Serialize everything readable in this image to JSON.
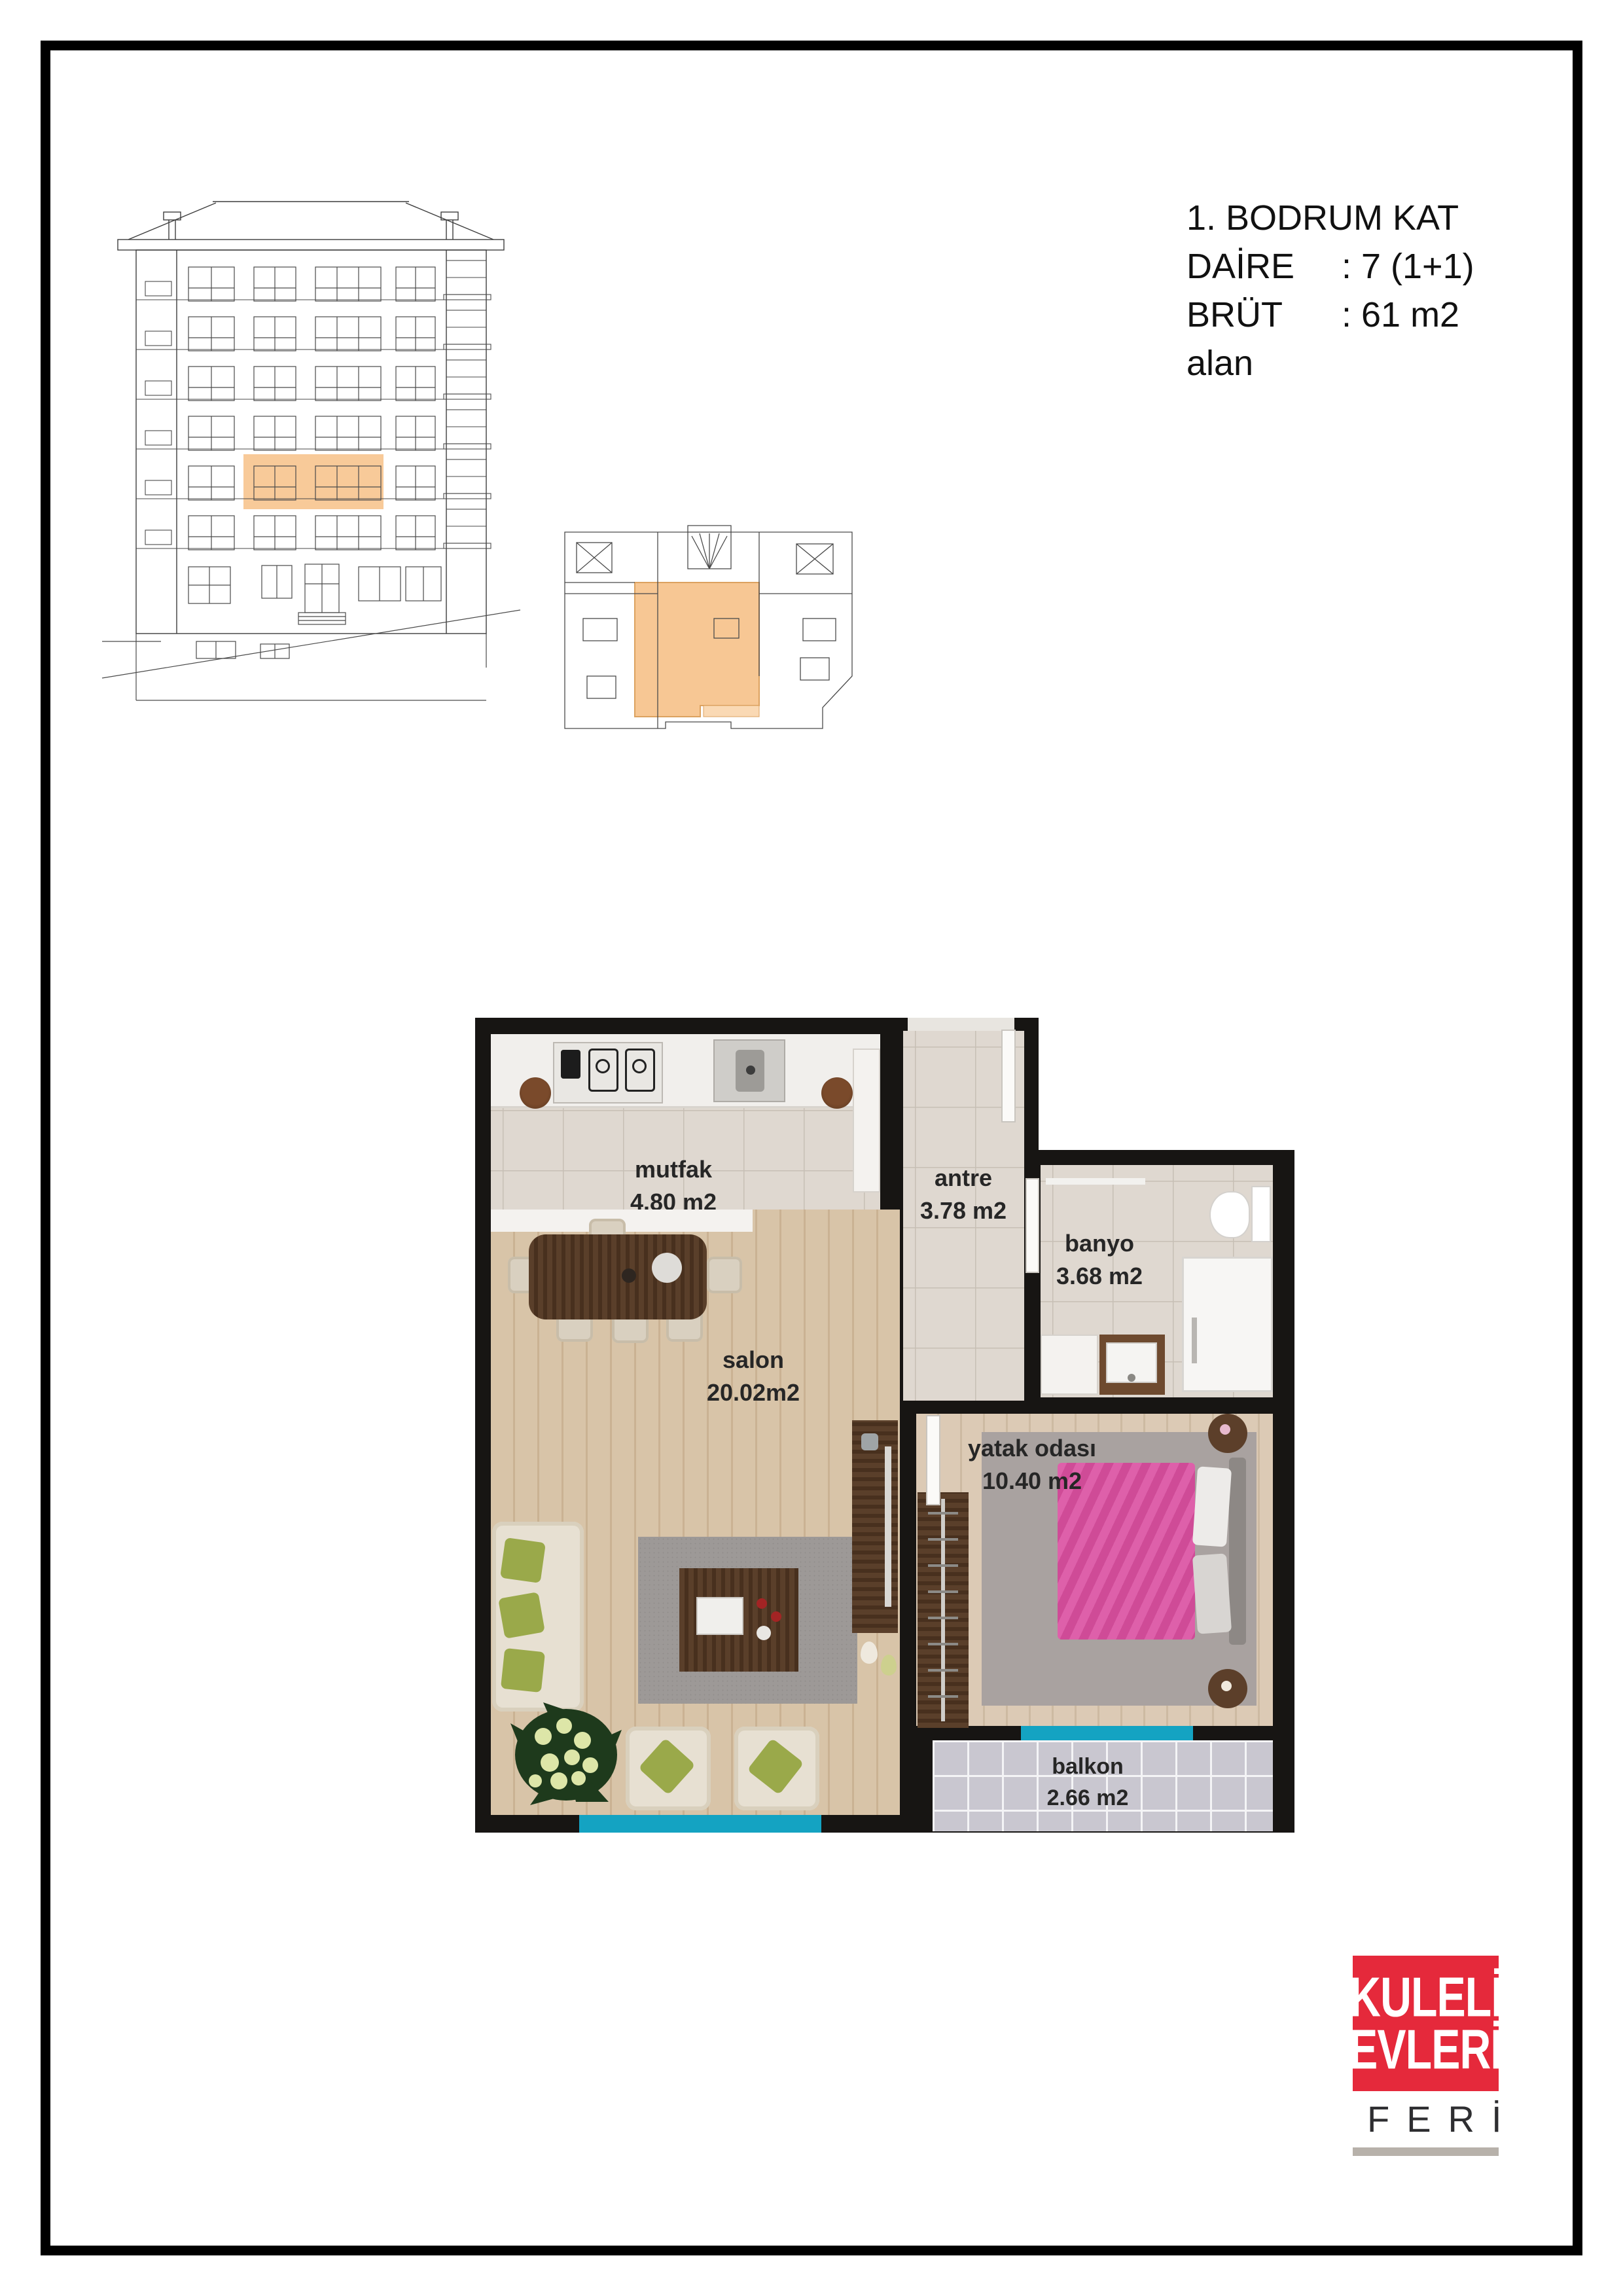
{
  "header": {
    "floor": "1. BODRUM KAT",
    "daire_label": "DAİRE",
    "daire_value": ": 7 (1+1)",
    "brut_label": "BRÜT alan",
    "brut_value": ": 61 m2"
  },
  "plan": {
    "rooms": [
      {
        "name": "mutfak",
        "area": "4.80 m2"
      },
      {
        "name": "antre",
        "area": "3.78 m2"
      },
      {
        "name": "banyo",
        "area": "3.68 m2"
      },
      {
        "name": "salon",
        "area": "20.02m2"
      },
      {
        "name": "yatak odası",
        "area": "10.40 m2"
      },
      {
        "name": "balkon",
        "area": "2.66 m2"
      }
    ]
  },
  "logo": {
    "line1": "KULELİ",
    "line2": "EVLERİ",
    "sub": "FERİ"
  },
  "colors": {
    "highlight_orange": "#F8C794",
    "window_teal": "#14A3C2",
    "wall_black": "#171513",
    "logo_red": "#E5293B",
    "logo_bar_gray": "#B7B1AA"
  }
}
